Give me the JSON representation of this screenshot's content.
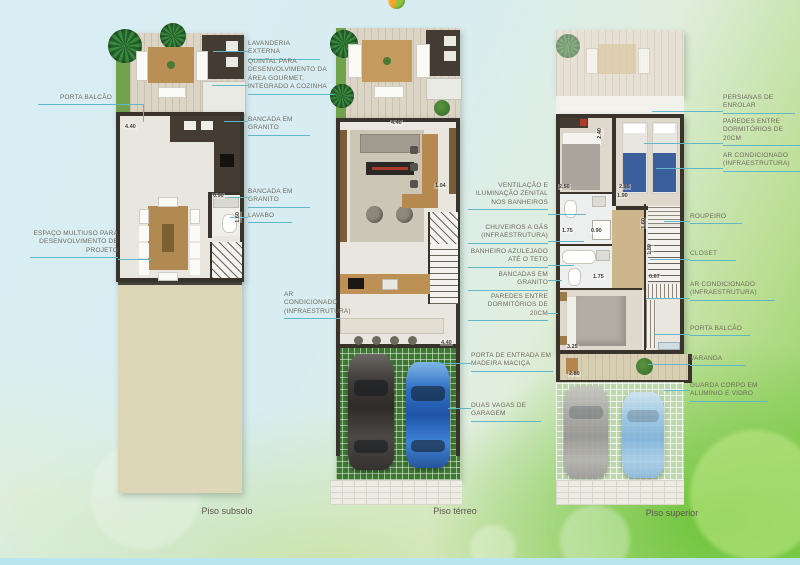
{
  "captions": {
    "subsolo": "Piso subsolo",
    "terreo": "Piso térreo",
    "superior": "Piso superior"
  },
  "callouts": {
    "subsolo": [
      "PORTA BALCÃO",
      "ESPAÇO MULTIUSO PARA DESENVOLVIMENTO DE PROJETO",
      "LAVANDERIA EXTERNA",
      "QUINTAL PARA DESENVOLVIMENTO DA ÁREA GOURMET, INTEGRADO A COZINHA",
      "BANCADA EM GRANITO",
      "BANCADA EM GRANITO",
      "LAVABO"
    ],
    "terreo": [
      "AR CONDICIONADO (INFRAESTRUTURA)",
      "PORTA DE ENTRADA EM MADEIRA MACIÇA",
      "DUAS VAGAS DE GARAGEM"
    ],
    "superior": [
      "VENTILAÇÃO E ILUMINAÇÃO ZENITAL NOS BANHEIROS",
      "CHUVEIROS A GÁS (INFRAESTRUTURA)",
      "BANHEIRO AZULEJADO ATÉ O TETO",
      "BANCADAS EM GRANITO",
      "PAREDES ENTRE DORMITÓRIOS DE 20CM",
      "PERSIANAS DE ENROLAR",
      "PAREDES ENTRE DORMITÓRIOS DE 20CM",
      "AR CONDICIONADO (INFRAESTRUTURA)",
      "ROUPEIRO",
      "CLOSET",
      "AR CONDICIONADO (INFRAESTRUTURA)",
      "PORTA BALCÃO",
      "VARANDA",
      "GUARDA CORPO EM ALUMÍNIO E VIDRO"
    ]
  },
  "dimensions": {
    "subsolo": [
      "4.40",
      "0.90",
      "1.60"
    ],
    "terreo": [
      "4.40",
      "1.04",
      "4.40"
    ],
    "superior": [
      "2.50",
      "2.95",
      "1.90",
      "2.40",
      "1.75",
      "0.90",
      "1.75",
      "0.67",
      "1.60",
      "1.80",
      "3.25",
      "2.80"
    ]
  },
  "icons": {
    "brand_logo": "orange-green-sphere",
    "palm": "palm-tree-top-view",
    "plant": "round-shrub"
  },
  "colors": {
    "leader_line": "#5fb7c8",
    "wall": "#3a332c",
    "label_text": "#6f695c",
    "garage_pavers": "#3c7a31",
    "multiuse_area": "#ded7b7"
  }
}
